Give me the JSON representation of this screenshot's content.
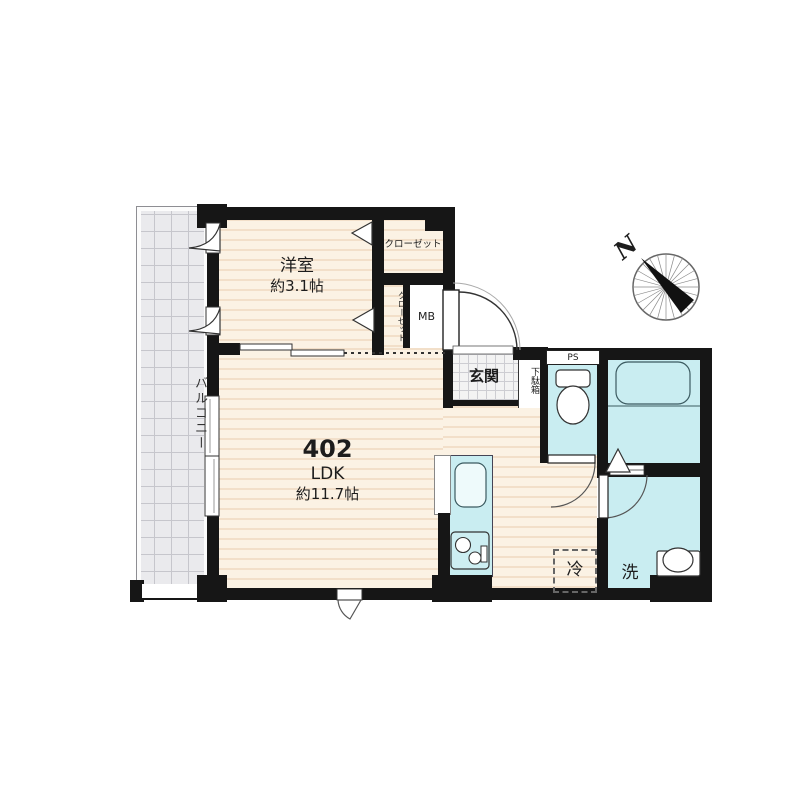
{
  "plan": {
    "balcony": {
      "label": "バルコニー"
    },
    "bedroom": {
      "name": "洋室",
      "size": "約3.1帖"
    },
    "closet_top": {
      "label": "クローゼット"
    },
    "closet_side": {
      "label": "クローゼット"
    },
    "meter_box": {
      "label": "MB"
    },
    "entrance": {
      "label": "玄関"
    },
    "shoe_cabinet": {
      "label": "下駄箱"
    },
    "pipe_space": {
      "label": "PS"
    },
    "ldk": {
      "unit_number": "402",
      "room_type": "LDK",
      "size": "約11.7帖"
    },
    "refrigerator_space": {
      "label": "冷"
    },
    "washer_space": {
      "label": "洗"
    },
    "compass": {
      "north_label": "N"
    },
    "colors": {
      "wall": "#161616",
      "floor": "#fbf2e4",
      "floor_stripe": "#f2dfc9",
      "wet_area": "#c9edf1",
      "balcony": "#eaeaed",
      "entrance_tile": "#f3f3f3",
      "background": "#ffffff"
    }
  }
}
